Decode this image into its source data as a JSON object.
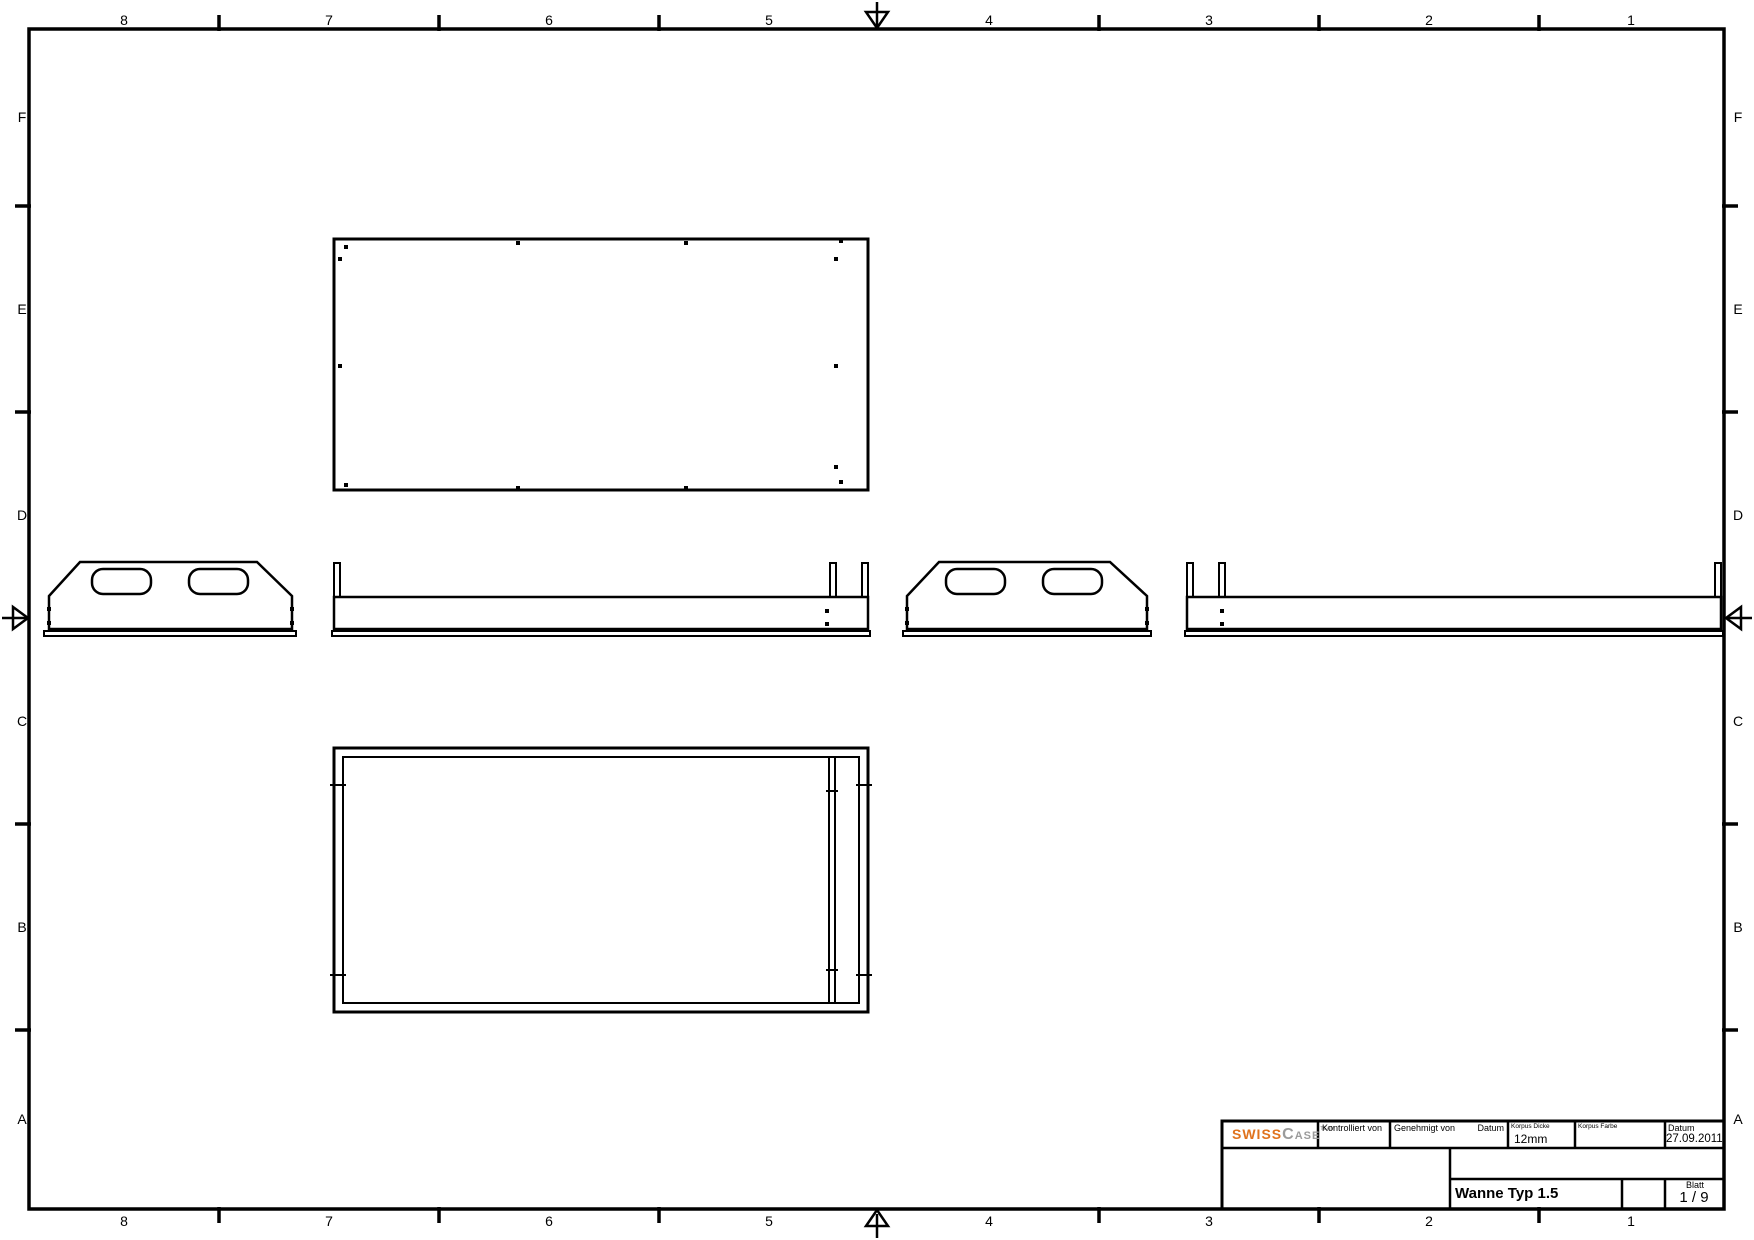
{
  "sheet": {
    "width": 1754,
    "height": 1240,
    "bg": "#ffffff",
    "line_color": "#000000"
  },
  "border": {
    "columns": {
      "labels": [
        "8",
        "7",
        "6",
        "5",
        "4",
        "3",
        "2",
        "1"
      ],
      "centers_x": [
        124,
        329,
        549,
        769,
        989,
        1209,
        1429,
        1631
      ],
      "top_y": 11,
      "bottom_y": 1212
    },
    "rows": {
      "labels": [
        "F",
        "E",
        "D",
        "C",
        "B",
        "A"
      ],
      "centers_y": [
        117,
        309,
        515,
        721,
        927,
        1119
      ],
      "left_x": 10,
      "right_x": 1726
    }
  },
  "title_block": {
    "logo": {
      "word1": "SWISS",
      "word2_initial": "C",
      "word2_rest": "ASE",
      "sup": "TEAM",
      "word1_color": "#e0731d",
      "word2_color": "#9b9b9b"
    },
    "kontrolliert_label": "Kontrolliert von",
    "genehmigt_label": "Genehmigt von",
    "genehmigt_datum_label": "Datum",
    "korpus_dicke_label": "Korpus Dicke",
    "korpus_dicke_value": "12mm",
    "korpus_farbe_label": "Korpus Farbe",
    "datum_label": "Datum",
    "datum_value": "27.09.2011",
    "part_name": "Wanne Typ 1.5",
    "blatt_label": "Blatt",
    "blatt_value": "1 / 9"
  },
  "drawing": {
    "groups": [
      {
        "name": "sheet-frame",
        "shapes": [
          {
            "t": "rect",
            "x": 29,
            "y": 29,
            "w": 1695,
            "h": 1180,
            "sw": 3.5
          },
          {
            "t": "line",
            "x1": 219,
            "y1": 15,
            "x2": 219,
            "y2": 31,
            "sw": 3.5
          },
          {
            "t": "line",
            "x1": 439,
            "y1": 15,
            "x2": 439,
            "y2": 31,
            "sw": 3.5
          },
          {
            "t": "line",
            "x1": 659,
            "y1": 15,
            "x2": 659,
            "y2": 31,
            "sw": 3.5
          },
          {
            "t": "line",
            "x1": 1099,
            "y1": 15,
            "x2": 1099,
            "y2": 31,
            "sw": 3.5
          },
          {
            "t": "line",
            "x1": 1319,
            "y1": 15,
            "x2": 1319,
            "y2": 31,
            "sw": 3.5
          },
          {
            "t": "line",
            "x1": 1539,
            "y1": 15,
            "x2": 1539,
            "y2": 31,
            "sw": 3.5
          },
          {
            "t": "line",
            "x1": 219,
            "y1": 1207,
            "x2": 219,
            "y2": 1223,
            "sw": 3.5
          },
          {
            "t": "line",
            "x1": 439,
            "y1": 1207,
            "x2": 439,
            "y2": 1223,
            "sw": 3.5
          },
          {
            "t": "line",
            "x1": 659,
            "y1": 1207,
            "x2": 659,
            "y2": 1223,
            "sw": 3.5
          },
          {
            "t": "line",
            "x1": 1099,
            "y1": 1207,
            "x2": 1099,
            "y2": 1223,
            "sw": 3.5
          },
          {
            "t": "line",
            "x1": 1319,
            "y1": 1207,
            "x2": 1319,
            "y2": 1223,
            "sw": 3.5
          },
          {
            "t": "line",
            "x1": 1539,
            "y1": 1207,
            "x2": 1539,
            "y2": 1223,
            "sw": 3.5
          },
          {
            "t": "line",
            "x1": 15,
            "y1": 206,
            "x2": 31,
            "y2": 206,
            "sw": 3.5
          },
          {
            "t": "line",
            "x1": 15,
            "y1": 412,
            "x2": 31,
            "y2": 412,
            "sw": 3.5
          },
          {
            "t": "line",
            "x1": 15,
            "y1": 824,
            "x2": 31,
            "y2": 824,
            "sw": 3.5
          },
          {
            "t": "line",
            "x1": 15,
            "y1": 1030,
            "x2": 31,
            "y2": 1030,
            "sw": 3.5
          },
          {
            "t": "line",
            "x1": 1722,
            "y1": 206,
            "x2": 1738,
            "y2": 206,
            "sw": 3.5
          },
          {
            "t": "line",
            "x1": 1722,
            "y1": 412,
            "x2": 1738,
            "y2": 412,
            "sw": 3.5
          },
          {
            "t": "line",
            "x1": 1722,
            "y1": 824,
            "x2": 1738,
            "y2": 824,
            "sw": 3.5
          },
          {
            "t": "line",
            "x1": 1722,
            "y1": 1030,
            "x2": 1738,
            "y2": 1030,
            "sw": 3.5
          }
        ]
      },
      {
        "name": "centering-marks",
        "shapes": [
          {
            "t": "line",
            "x1": 877,
            "y1": 2,
            "x2": 877,
            "y2": 26,
            "sw": 2.5
          },
          {
            "t": "poly",
            "pts": "866,12 888,12 877,28",
            "sw": 2.5
          },
          {
            "t": "line",
            "x1": 877,
            "y1": 1238,
            "x2": 877,
            "y2": 1214,
            "sw": 2.5
          },
          {
            "t": "poly",
            "pts": "866,1226 888,1226 877,1210",
            "sw": 2.5
          },
          {
            "t": "line",
            "x1": 2,
            "y1": 618,
            "x2": 26,
            "y2": 618,
            "sw": 2.5
          },
          {
            "t": "poly",
            "pts": "13,607 13,629 28,618",
            "sw": 2.5
          },
          {
            "t": "line",
            "x1": 1752,
            "y1": 618,
            "x2": 1728,
            "y2": 618,
            "sw": 2.5
          },
          {
            "t": "poly",
            "pts": "1741,607 1741,629 1726,618",
            "sw": 2.5
          }
        ]
      },
      {
        "name": "top-view",
        "shapes": [
          {
            "t": "rect",
            "x": 334,
            "y": 239,
            "w": 534,
            "h": 251,
            "sw": 3
          },
          {
            "t": "dot",
            "x": 346,
            "y": 247,
            "s": 4
          },
          {
            "t": "dot",
            "x": 518,
            "y": 243,
            "s": 4
          },
          {
            "t": "dot",
            "x": 686,
            "y": 243,
            "s": 4
          },
          {
            "t": "dot",
            "x": 841,
            "y": 241,
            "s": 4
          },
          {
            "t": "dot",
            "x": 836,
            "y": 259,
            "s": 4
          },
          {
            "t": "dot",
            "x": 836,
            "y": 366,
            "s": 4
          },
          {
            "t": "dot",
            "x": 836,
            "y": 467,
            "s": 4
          },
          {
            "t": "dot",
            "x": 841,
            "y": 482,
            "s": 4
          },
          {
            "t": "dot",
            "x": 686,
            "y": 488,
            "s": 4
          },
          {
            "t": "dot",
            "x": 518,
            "y": 488,
            "s": 4
          },
          {
            "t": "dot",
            "x": 346,
            "y": 485,
            "s": 4
          },
          {
            "t": "dot",
            "x": 340,
            "y": 259,
            "s": 4
          },
          {
            "t": "dot",
            "x": 340,
            "y": 366,
            "s": 4
          }
        ]
      },
      {
        "name": "end-panel-left-view",
        "shapes": [
          {
            "t": "poly",
            "pts": "80,562 257,562 292,596 292,629 49,629 49,596",
            "sw": 2.5
          },
          {
            "t": "rect",
            "x": 44,
            "y": 631,
            "w": 252,
            "h": 5,
            "sw": 2
          },
          {
            "t": "rrect",
            "x": 92,
            "y": 569,
            "w": 59,
            "h": 25,
            "r": 11,
            "sw": 2.5
          },
          {
            "t": "rrect",
            "x": 189,
            "y": 569,
            "w": 59,
            "h": 25,
            "r": 11,
            "sw": 2.5
          },
          {
            "t": "dot",
            "x": 49,
            "y": 609,
            "s": 4
          },
          {
            "t": "dot",
            "x": 49,
            "y": 623,
            "s": 4
          },
          {
            "t": "dot",
            "x": 292,
            "y": 609,
            "s": 4
          },
          {
            "t": "dot",
            "x": 292,
            "y": 623,
            "s": 4
          }
        ]
      },
      {
        "name": "front-rail-view",
        "shapes": [
          {
            "t": "rect",
            "x": 334,
            "y": 563,
            "w": 6,
            "h": 34,
            "sw": 2
          },
          {
            "t": "rect",
            "x": 830,
            "y": 563,
            "w": 6,
            "h": 34,
            "sw": 2
          },
          {
            "t": "rect",
            "x": 862,
            "y": 563,
            "w": 6,
            "h": 34,
            "sw": 2
          },
          {
            "t": "rect",
            "x": 334,
            "y": 597,
            "w": 534,
            "h": 32,
            "sw": 2.5
          },
          {
            "t": "rect",
            "x": 332,
            "y": 631,
            "w": 538,
            "h": 5,
            "sw": 2
          },
          {
            "t": "dot",
            "x": 827,
            "y": 611,
            "s": 4
          },
          {
            "t": "dot",
            "x": 827,
            "y": 624,
            "s": 4
          }
        ]
      },
      {
        "name": "end-panel-right-view",
        "shapes": [
          {
            "t": "poly",
            "pts": "939,562 1110,562 1147,596 1147,629 907,629 907,596",
            "sw": 2.5
          },
          {
            "t": "rect",
            "x": 903,
            "y": 631,
            "w": 248,
            "h": 5,
            "sw": 2
          },
          {
            "t": "rrect",
            "x": 946,
            "y": 569,
            "w": 59,
            "h": 25,
            "r": 11,
            "sw": 2.5
          },
          {
            "t": "rrect",
            "x": 1043,
            "y": 569,
            "w": 59,
            "h": 25,
            "r": 11,
            "sw": 2.5
          },
          {
            "t": "dot",
            "x": 907,
            "y": 609,
            "s": 4
          },
          {
            "t": "dot",
            "x": 907,
            "y": 623,
            "s": 4
          },
          {
            "t": "dot",
            "x": 1147,
            "y": 609,
            "s": 4
          },
          {
            "t": "dot",
            "x": 1147,
            "y": 623,
            "s": 4
          }
        ]
      },
      {
        "name": "side-rail-view",
        "shapes": [
          {
            "t": "rect",
            "x": 1187,
            "y": 563,
            "w": 6,
            "h": 34,
            "sw": 2
          },
          {
            "t": "rect",
            "x": 1219,
            "y": 563,
            "w": 6,
            "h": 34,
            "sw": 2
          },
          {
            "t": "rect",
            "x": 1715,
            "y": 563,
            "w": 6,
            "h": 34,
            "sw": 2
          },
          {
            "t": "rect",
            "x": 1187,
            "y": 597,
            "w": 534,
            "h": 32,
            "sw": 2.5
          },
          {
            "t": "rect",
            "x": 1185,
            "y": 631,
            "w": 538,
            "h": 5,
            "sw": 2
          },
          {
            "t": "dot",
            "x": 1222,
            "y": 611,
            "s": 4
          },
          {
            "t": "dot",
            "x": 1222,
            "y": 624,
            "s": 4
          }
        ]
      },
      {
        "name": "bottom-plan-view",
        "shapes": [
          {
            "t": "rect",
            "x": 334,
            "y": 748,
            "w": 534,
            "h": 264,
            "sw": 3
          },
          {
            "t": "rect",
            "x": 343,
            "y": 757,
            "w": 516,
            "h": 246,
            "sw": 2
          },
          {
            "t": "rect",
            "x": 829,
            "y": 757,
            "w": 6,
            "h": 246,
            "sw": 2
          },
          {
            "t": "line",
            "x1": 330,
            "y1": 785,
            "x2": 346,
            "y2": 785,
            "sw": 2
          },
          {
            "t": "line",
            "x1": 330,
            "y1": 975,
            "x2": 346,
            "y2": 975,
            "sw": 2
          },
          {
            "t": "line",
            "x1": 856,
            "y1": 785,
            "x2": 872,
            "y2": 785,
            "sw": 2
          },
          {
            "t": "line",
            "x1": 856,
            "y1": 975,
            "x2": 872,
            "y2": 975,
            "sw": 2
          },
          {
            "t": "line",
            "x1": 826,
            "y1": 791,
            "x2": 838,
            "y2": 791,
            "sw": 2
          },
          {
            "t": "line",
            "x1": 826,
            "y1": 970,
            "x2": 838,
            "y2": 970,
            "sw": 2
          }
        ]
      },
      {
        "name": "title-block-grid",
        "shapes": [
          {
            "t": "rect",
            "x": 1222,
            "y": 1121,
            "w": 502,
            "h": 88,
            "sw": 3
          },
          {
            "t": "line",
            "x1": 1222,
            "y1": 1148,
            "x2": 1724,
            "y2": 1148,
            "sw": 2.5
          },
          {
            "t": "line",
            "x1": 1450,
            "y1": 1179,
            "x2": 1724,
            "y2": 1179,
            "sw": 2.5
          },
          {
            "t": "line",
            "x1": 1318,
            "y1": 1121,
            "x2": 1318,
            "y2": 1148,
            "sw": 2.5
          },
          {
            "t": "line",
            "x1": 1390,
            "y1": 1121,
            "x2": 1390,
            "y2": 1148,
            "sw": 2.5
          },
          {
            "t": "line",
            "x1": 1508,
            "y1": 1121,
            "x2": 1508,
            "y2": 1148,
            "sw": 2.5
          },
          {
            "t": "line",
            "x1": 1575,
            "y1": 1121,
            "x2": 1575,
            "y2": 1148,
            "sw": 2.5
          },
          {
            "t": "line",
            "x1": 1665,
            "y1": 1121,
            "x2": 1665,
            "y2": 1148,
            "sw": 2.5
          },
          {
            "t": "line",
            "x1": 1450,
            "y1": 1148,
            "x2": 1450,
            "y2": 1209,
            "sw": 2.5
          },
          {
            "t": "line",
            "x1": 1622,
            "y1": 1179,
            "x2": 1622,
            "y2": 1209,
            "sw": 2.5
          },
          {
            "t": "line",
            "x1": 1665,
            "y1": 1179,
            "x2": 1665,
            "y2": 1209,
            "sw": 2.5
          }
        ]
      }
    ]
  }
}
